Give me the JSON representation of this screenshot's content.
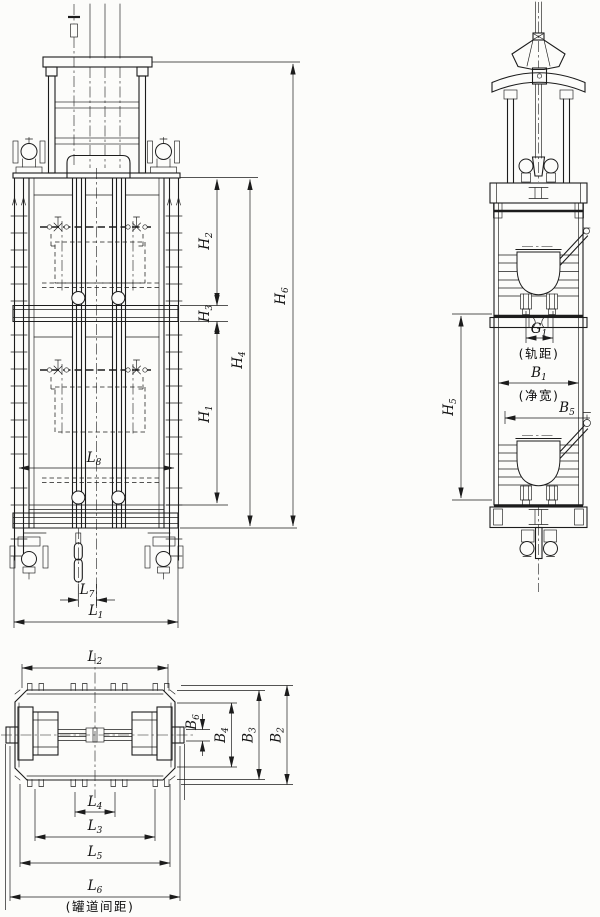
{
  "dims": {
    "H1": {
      "base": "H",
      "sub": "1"
    },
    "H2": {
      "base": "H",
      "sub": "2"
    },
    "H3": {
      "base": "H",
      "sub": "3"
    },
    "H4": {
      "base": "H",
      "sub": "4"
    },
    "H5": {
      "base": "H",
      "sub": "5"
    },
    "H6": {
      "base": "H",
      "sub": "6"
    },
    "L1": {
      "base": "L",
      "sub": "1"
    },
    "L2": {
      "base": "L",
      "sub": "2"
    },
    "L3": {
      "base": "L",
      "sub": "3"
    },
    "L4": {
      "base": "L",
      "sub": "4"
    },
    "L5": {
      "base": "L",
      "sub": "5"
    },
    "L6": {
      "base": "L",
      "sub": "6"
    },
    "L7": {
      "base": "L",
      "sub": "7"
    },
    "L8": {
      "base": "L",
      "sub": "8"
    },
    "B1": {
      "base": "B",
      "sub": "1"
    },
    "B2": {
      "base": "B",
      "sub": "2"
    },
    "B3": {
      "base": "B",
      "sub": "3"
    },
    "B4": {
      "base": "B",
      "sub": "4"
    },
    "B5": {
      "base": "B",
      "sub": "5"
    },
    "B6": {
      "base": "B",
      "sub": "6"
    },
    "G1": {
      "base": "G",
      "sub": "1"
    }
  },
  "annotations": {
    "rail_gauge": "(轨距)",
    "clear_width": "(净宽)",
    "guide_spacing": "(罐道间距)"
  }
}
